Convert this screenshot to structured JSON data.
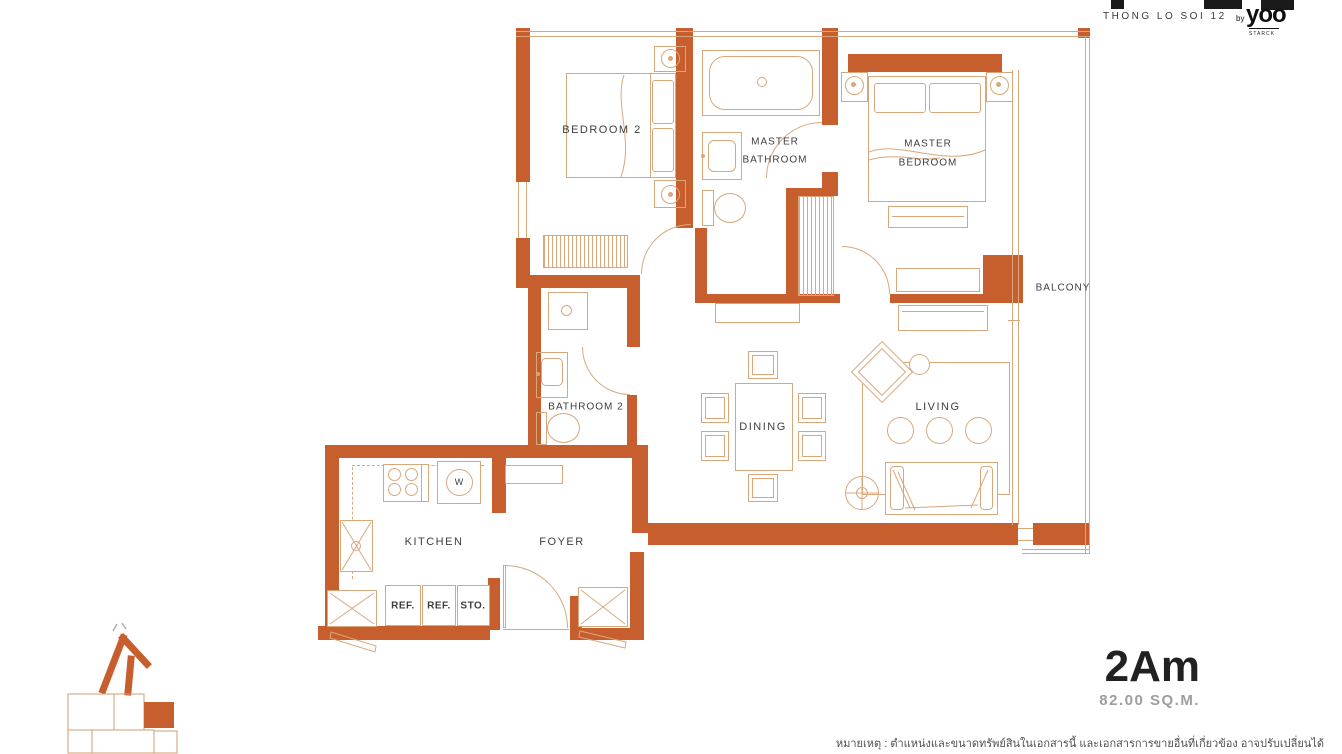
{
  "header": {
    "project": "THONG LO SOI 12",
    "brand_by": "by",
    "brand": "yoo",
    "brand_sub": "STARCK"
  },
  "unit": {
    "name": "2Am",
    "area": "82.00 SQ.M."
  },
  "rooms": {
    "bedroom2": "BEDROOM 2",
    "master_bath_1": "MASTER",
    "master_bath_2": "BATHROOM",
    "master_bed_1": "MASTER",
    "master_bed_2": "BEDROOM",
    "balcony": "BALCONY",
    "bathroom2": "BATHROOM 2",
    "dining": "DINING",
    "living": "LIVING",
    "kitchen": "KITCHEN",
    "foyer": "FOYER"
  },
  "appliances": {
    "washer": "W",
    "ref1": "REF.",
    "ref2": "REF.",
    "storage": "STO."
  },
  "footnote": "หมายเหตุ : ตำแหน่งและขนาดทรัพย์สินในเอกสารนี้ และเอกสารการขายอื่นที่เกี่ยวข้อง อาจปรับเปลี่ยนได้",
  "colors": {
    "wall": "#c65e2d",
    "line": "#d8a87c",
    "text": "#3e3e3e",
    "ink": "#1c1c1c",
    "muted": "#9e9e9e"
  }
}
